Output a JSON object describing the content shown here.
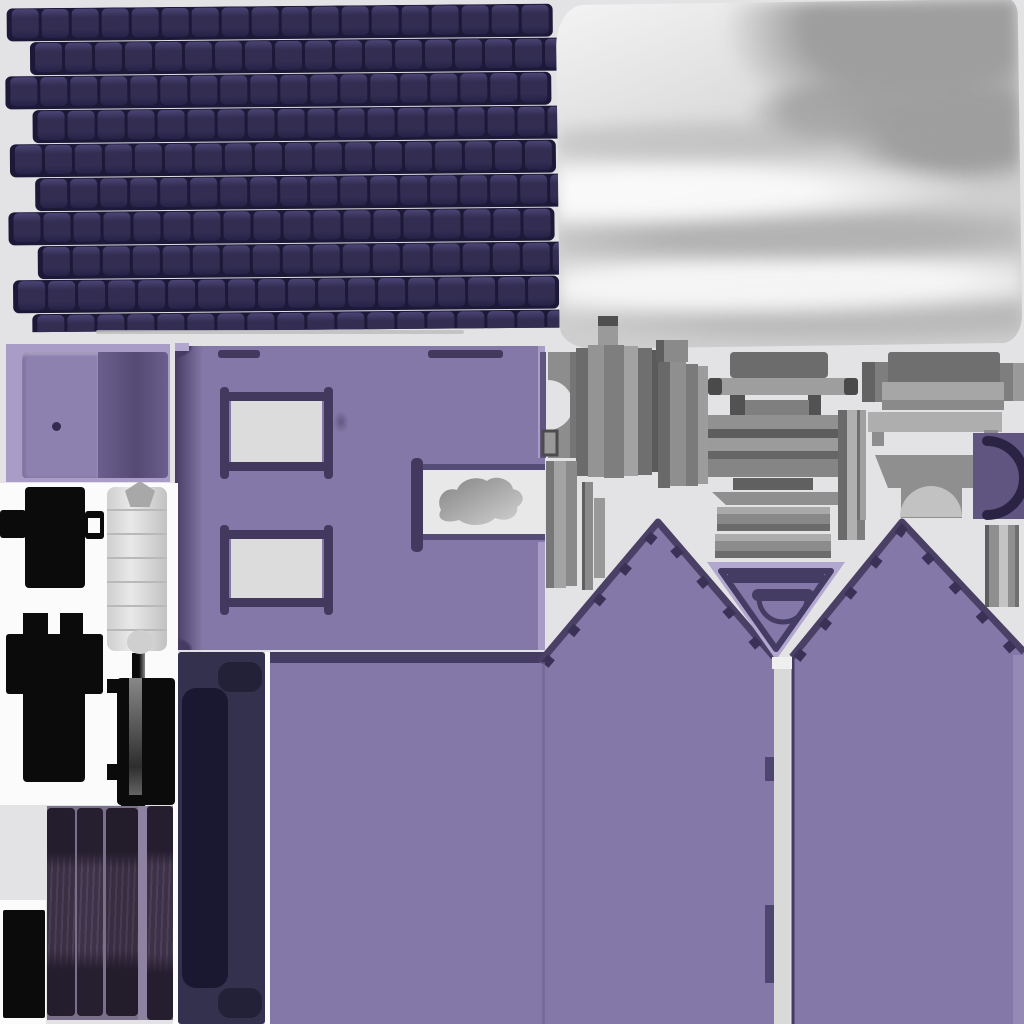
{
  "atlas": {
    "kind": "baked-texture-atlas",
    "regions": [
      "roof-shingles",
      "satin-fabric",
      "door-card",
      "wall-with-windows",
      "window-niche-cloth",
      "stove-silhouette",
      "chimney-silhouette",
      "fixture-silhouette",
      "mattress-roll",
      "plank-boards",
      "ink-rectangle",
      "navy-headboard",
      "purple-sheet",
      "gable-walls",
      "v-inset-arch",
      "gray-furniture-parts",
      "fireplace-dome",
      "c-arch-piece"
    ]
  },
  "palette": {
    "bg": "#e3e2e4",
    "white_panel": "#fbfbfb",
    "strip_gray": "#d9d9d9",
    "roof_tile": "#322d51",
    "roof_tile_hi": "#4b4476",
    "roof_tile_lo": "#262148",
    "roof_gap": "#1c1837",
    "roof_shadow": "#bdbdbd",
    "fabric_light": "#f3f3f3",
    "fabric_mid": "#cecece",
    "fabric_dark": "#9e9e9e",
    "lilac": "#a99dc8",
    "lilac_bright": "#b2a7ce",
    "door_left": "#8d81b0",
    "door_right_a": "#6b5f8d",
    "door_right_b": "#544a74",
    "door_knob": "#332c4e",
    "wall": "#8478a8",
    "wall_edge": "#463c62",
    "frame_dark": "#43395e",
    "frame_mid": "#564c78",
    "pane": "#dcdcdd",
    "pane_bright": "#e8e8e8",
    "navy": "#34314e",
    "navy_inner": "#191830",
    "navy_tab": "#232138",
    "ink": "#0b0b0b",
    "plank": "#3a3044",
    "plank_dark": "#231d2d",
    "plank_grain": "#4a3d54",
    "plank_gap": "#7b7089",
    "plank_gap_light": "#8d82a0",
    "gable_edge": "#4a4066",
    "gable_notch": "#3a3157",
    "v_dark": "#453c63",
    "v_tab": "#4f4670",
    "gable_band": "#948ab6",
    "purple_part": "#5f5580",
    "arch_ink": "#2a2343",
    "seam": "#6d628f"
  },
  "roof": {
    "rows": 10,
    "cols": 18,
    "tile_w": 27,
    "tile_h": 29,
    "row_offsets": [
      2,
      12,
      0,
      14,
      4,
      16,
      2,
      18,
      6,
      12
    ]
  }
}
